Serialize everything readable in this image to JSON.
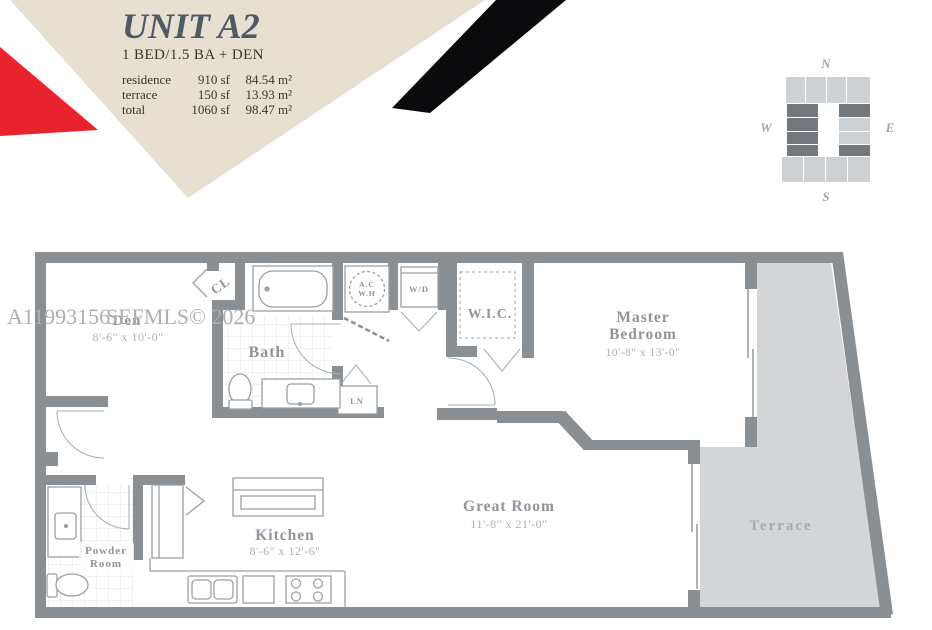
{
  "header": {
    "title": "UNIT A2",
    "subtitle": "1 BED/1.5 BA + DEN",
    "area_rows": [
      {
        "label": "residence",
        "sf": "910 sf",
        "sqm": "84.54 m²"
      },
      {
        "label": "terrace",
        "sf": "150 sf",
        "sqm": "13.93 m²"
      },
      {
        "label": "total",
        "sf": "1060 sf",
        "sqm": "98.47 m²"
      }
    ]
  },
  "watermark": {
    "id": "A11993156",
    "source": "SEFMLS© 2026"
  },
  "keyplan": {
    "n": "N",
    "e": "E",
    "s": "S",
    "w": "W"
  },
  "rooms": {
    "den": {
      "name": "Den",
      "dims": "8'-6\" x 10'-0\""
    },
    "cl": {
      "name": "CL"
    },
    "bath": {
      "name": "Bath"
    },
    "ac": {
      "line1": "A.C",
      "line2": "W.H"
    },
    "wd": {
      "name": "W/D"
    },
    "wic": {
      "name": "W.I.C."
    },
    "ln": {
      "name": "LN"
    },
    "master": {
      "line1": "Master",
      "line2": "Bedroom",
      "dims": "10'-8\" x 13'-0\""
    },
    "powder": {
      "line1": "Powder",
      "line2": "Room"
    },
    "kitchen": {
      "name": "Kitchen",
      "dims": "8'-6\" x 12'-6\""
    },
    "great": {
      "name": "Great Room",
      "dims": "11'-8\" x 21'-0\""
    },
    "terrace": {
      "name": "Terrace"
    }
  },
  "colors": {
    "banner_beige": "#e7e0d1",
    "accent_red": "#e9232e",
    "accent_black": "#0b0b0d",
    "title_slate": "#4e5a66",
    "wall_gray": "#8a8f93",
    "terrace_fill": "#d3d5d7",
    "label_gray": "#8e9499",
    "watermark_gray": "#aeaeae"
  }
}
